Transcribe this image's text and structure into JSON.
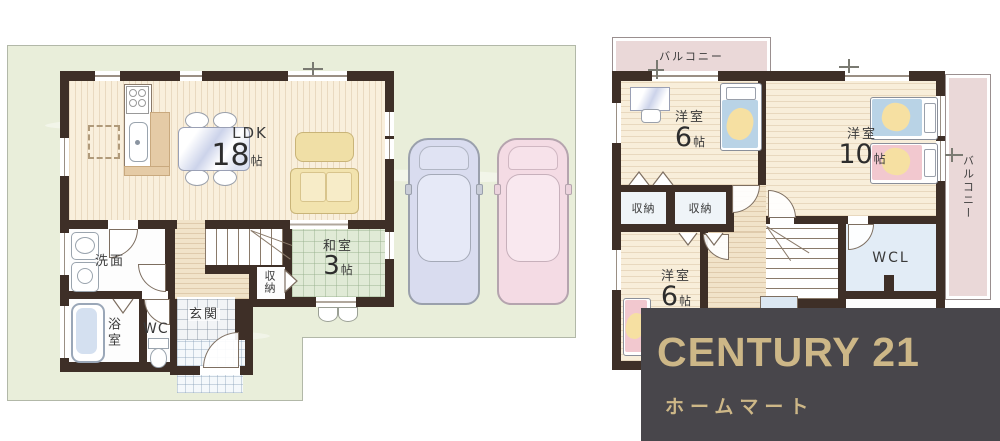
{
  "floor1": {
    "ldk": {
      "name": "LDK",
      "num": "18",
      "unit": "帖"
    },
    "washitsu": {
      "name": "和室",
      "num": "3",
      "unit": "帖"
    },
    "senmen": "洗面",
    "yokushitsu": "浴室",
    "wc": "WC",
    "genkan": "玄関",
    "shuno": "収納"
  },
  "floor2": {
    "balcony_top": "バルコニー",
    "balcony_right": "バルコニー",
    "room6_top": {
      "name": "洋室",
      "num": "6",
      "unit": "帖"
    },
    "room10": {
      "name": "洋室",
      "num": "10",
      "unit": "帖"
    },
    "shuno1": "収納",
    "shuno2": "収納",
    "wcl": "WCL",
    "room6_bottom": {
      "name": "洋室",
      "num": "6",
      "unit": "帖"
    }
  },
  "logo": {
    "brand": "CENTURY 21",
    "subtitle": "ホームマート"
  },
  "colors": {
    "wall": "#3e2f27",
    "wood_floor": "#f9efdc",
    "tatami": "#e0ead6",
    "lot_green": "#e9eeda",
    "balcony_pink": "#ead8d8",
    "wcl_blue": "#e2ecf6",
    "bed_blue": "#b9d3e6",
    "bed_pink": "#f2c8cf",
    "blanket_yellow": "#f6e0a2",
    "sofa_yellow": "#f2e3ae",
    "car_blue": "#d9dcef",
    "car_pink": "#f4dbe4",
    "logo_bg": "#48464b",
    "logo_gold": "#cdb787"
  }
}
